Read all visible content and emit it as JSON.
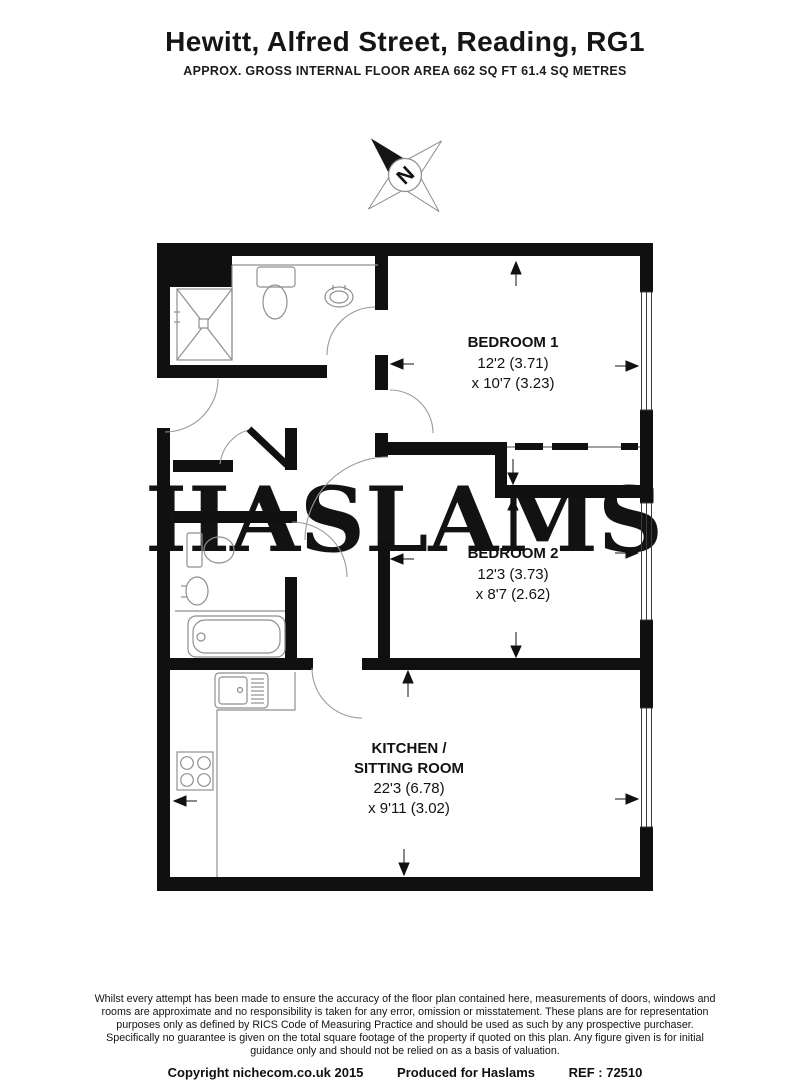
{
  "header": {
    "title": "Hewitt, Alfred Street, Reading, RG1",
    "subtitle": "APPROX. GROSS INTERNAL FLOOR AREA 662 SQ FT 61.4 SQ METRES"
  },
  "compass": {
    "label": "N"
  },
  "watermark": "HASLAMS",
  "rooms": {
    "bedroom1": {
      "name": "BEDROOM 1",
      "dim1": "12'2 (3.71)",
      "dim2": "x 10'7 (3.23)"
    },
    "bedroom2": {
      "name": "BEDROOM 2",
      "dim1": "12'3 (3.73)",
      "dim2": "x 8'7 (2.62)"
    },
    "kitchen": {
      "name1": "KITCHEN /",
      "name2": "SITTING ROOM",
      "dim1": "22'3 (6.78)",
      "dim2": "x 9'11 (3.02)"
    }
  },
  "footer": {
    "disclaimer_lines": [
      "Whilst every attempt has been made to ensure the accuracy of the floor plan contained here, measurements of doors, windows and",
      "rooms are approximate and no responsibility is taken for any error, omission or misstatement. These plans are for representation",
      "purposes only as defined by RICS Code of Measuring Practice and should be used as such by any prospective purchaser.",
      "Specifically no guarantee is given on the total square footage of the property if quoted on this plan. Any figure given is for initial",
      "guidance only and should not be relied on as a basis of valuation."
    ],
    "copyright": "Copyright nichecom.co.uk 2015",
    "produced": "Produced for Haslams",
    "ref": "REF : 72510"
  },
  "colors": {
    "wall": "#101010",
    "fixture": "#8f8f8f",
    "watermark": "#d4d4d4"
  }
}
